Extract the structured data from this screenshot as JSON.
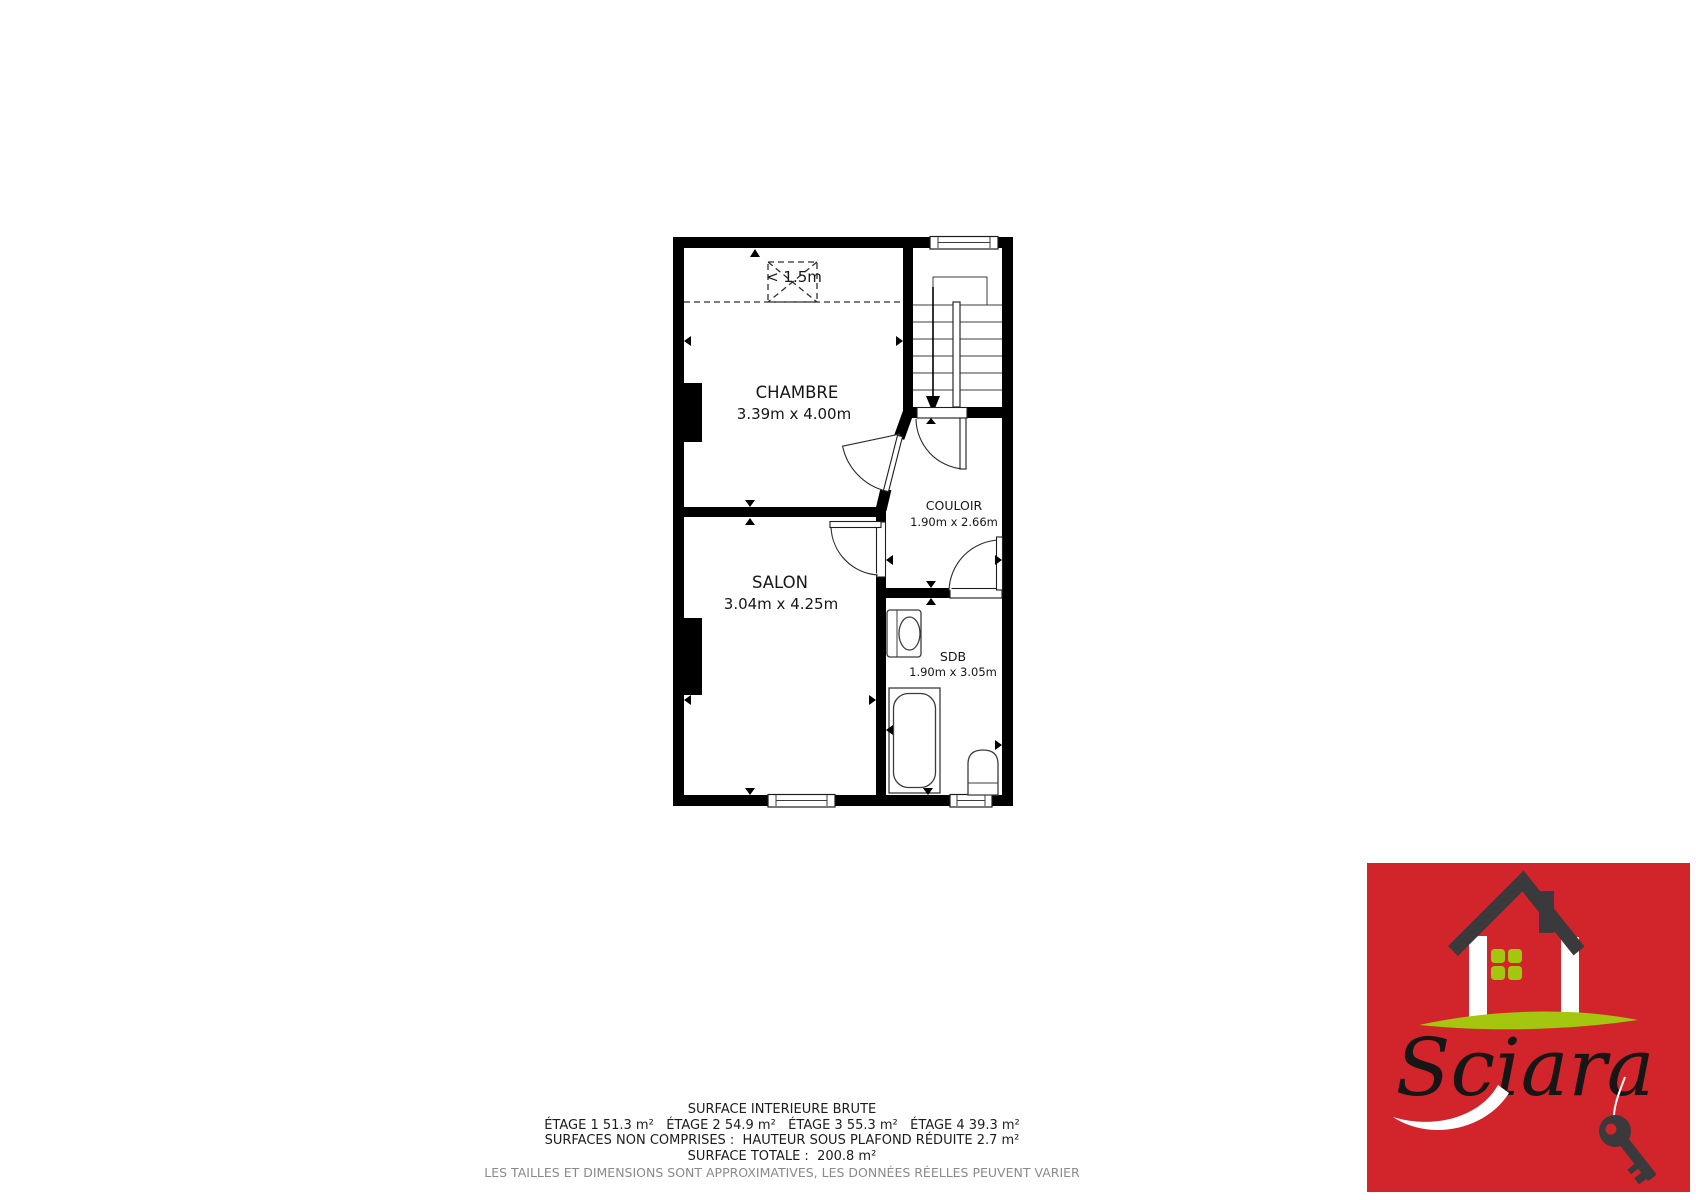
{
  "floor_plan": {
    "low_ceiling_label": "< 1.5m",
    "rooms": [
      {
        "name": "CHAMBRE",
        "dims": "3.39m x 4.00m"
      },
      {
        "name": "SALON",
        "dims": "3.04m x 4.25m"
      },
      {
        "name": "COULOIR",
        "dims": "1.90m x 2.66m"
      },
      {
        "name": "SDB",
        "dims": "1.90m x 3.05m"
      }
    ]
  },
  "footer": {
    "line1": "SURFACE INTERIEURE BRUTE",
    "line2": "ÉTAGE 1 51.3 m²   ÉTAGE 2 54.9 m²   ÉTAGE 3 55.3 m²   ÉTAGE 4 39.3 m²",
    "line3": "SURFACES NON COMPRISES :  HAUTEUR SOUS PLAFOND RÉDUITE 2.7 m²",
    "line4": "SURFACE TOTALE :  200.8 m²",
    "disclaimer": "LES TAILLES ET DIMENSIONS SONT APPROXIMATIVES, LES DONNÉES RÉELLES PEUVENT VARIER"
  },
  "logo": {
    "brand": "Sciara",
    "colors": {
      "red": "#d2242b",
      "green": "#a4c60f",
      "dark": "#3a3a3c"
    }
  }
}
